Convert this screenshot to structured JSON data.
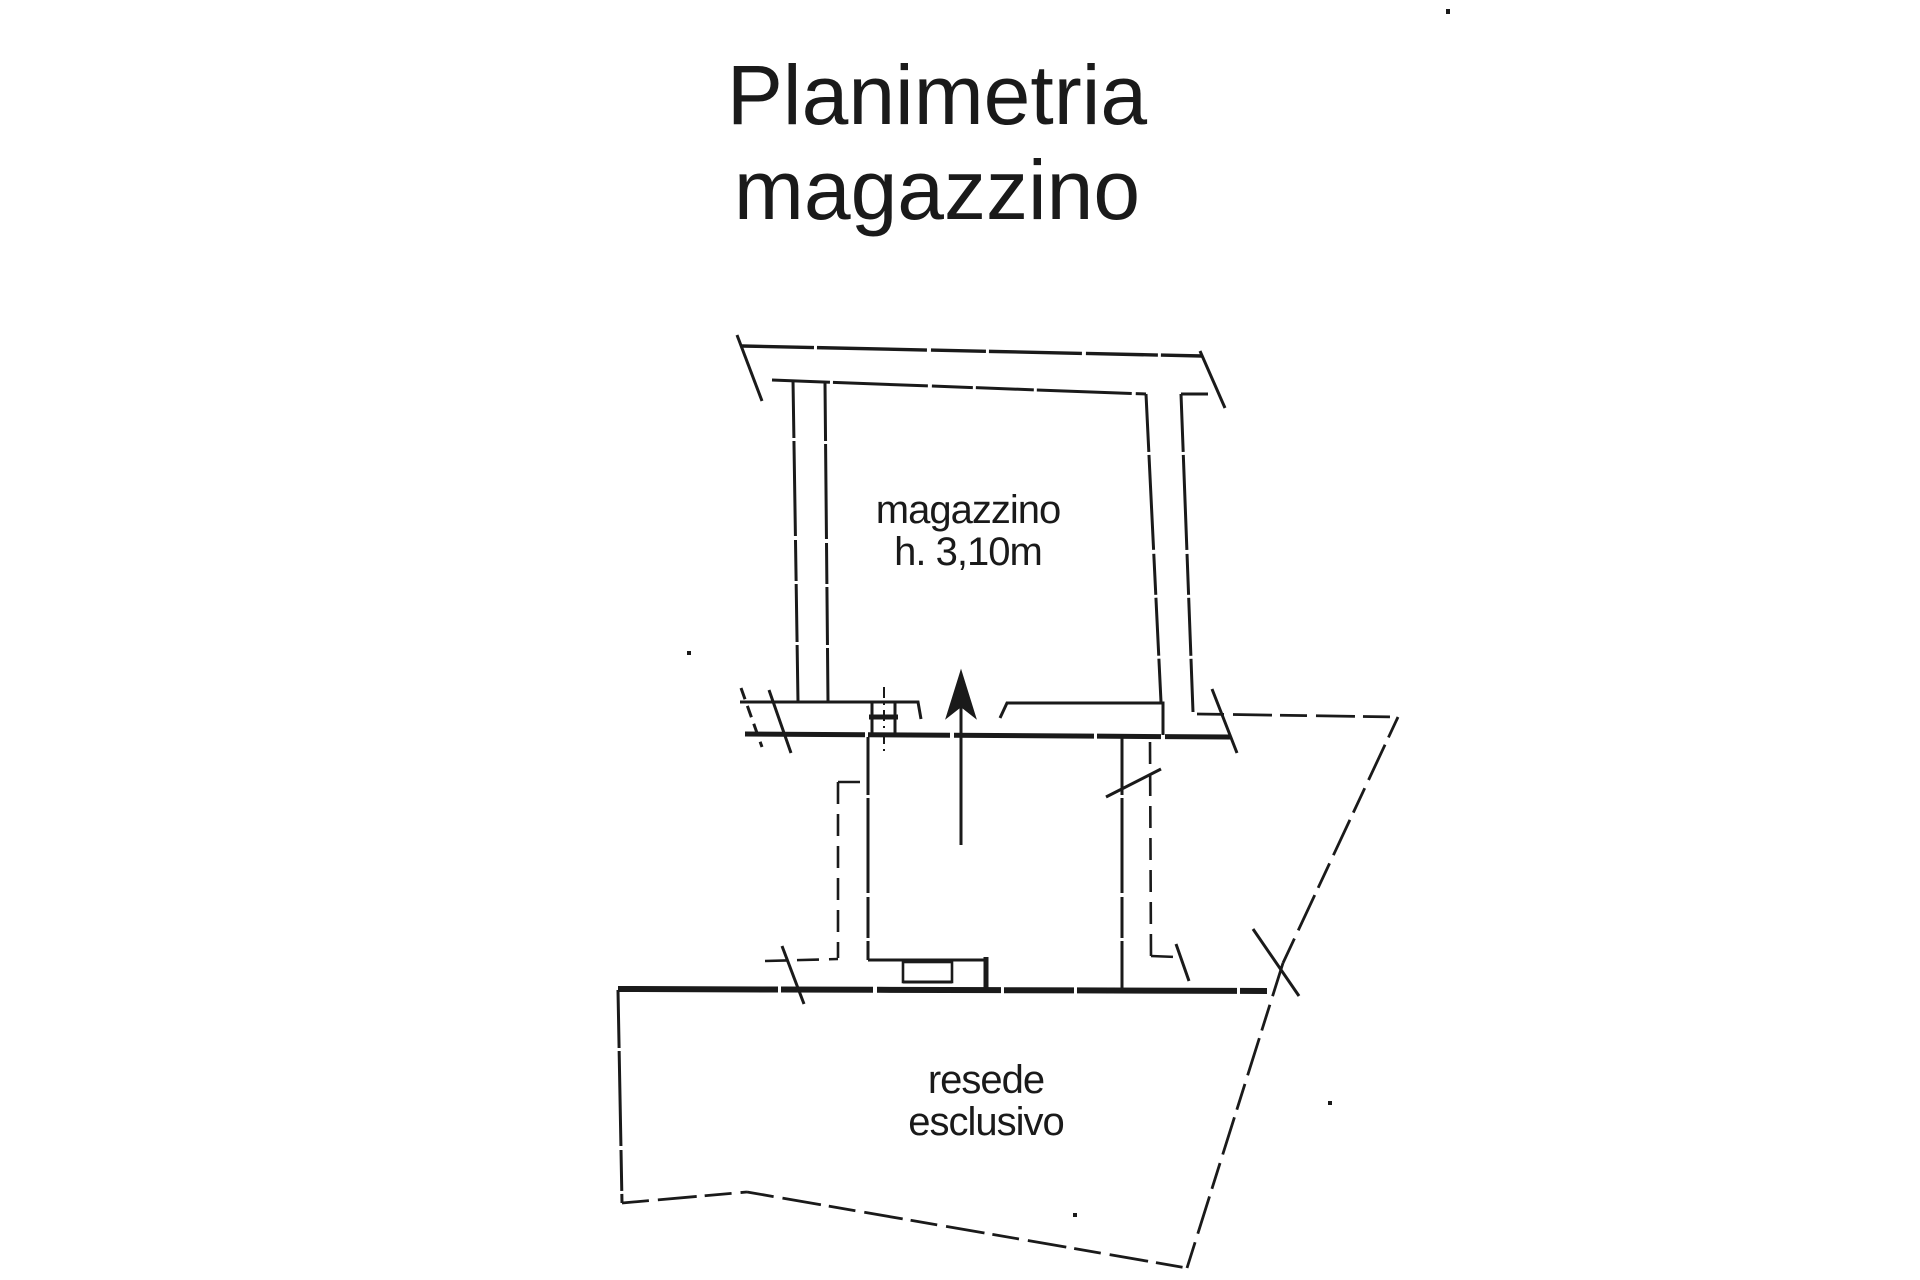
{
  "page": {
    "kind": "scanned floor plan sheet",
    "colors": {
      "paper": "#ffffff",
      "ink": "#1a1a1a"
    }
  },
  "title": {
    "line1": "Planimetria",
    "line2": "magazzino"
  },
  "labels": {
    "room": {
      "line1": "magazzino",
      "line2": "h. 3,10m"
    },
    "yard": {
      "line1": "resede",
      "line2": "esclusivo"
    }
  },
  "icons": {
    "entrance_arrow": "up-arrow"
  }
}
